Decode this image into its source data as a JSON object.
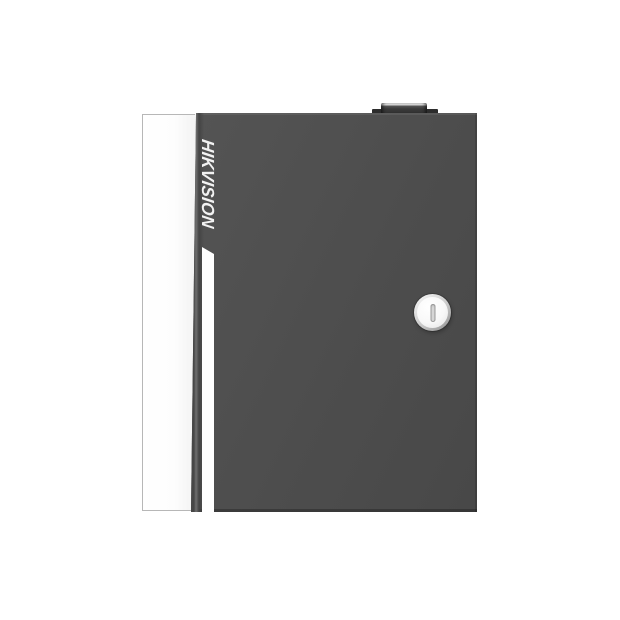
{
  "scene": {
    "background_color": "#ffffff"
  },
  "device": {
    "brand_label": "HIKVISION",
    "colors": {
      "door_face": "#4e4e4e",
      "door_edge_highlight": "#6f6f6f",
      "door_edge_shadow": "#454545",
      "door_bottom_edge": "#3a3a3a",
      "side_panel": "#ffffff",
      "side_panel_border": "#b7b7b7",
      "accent_stripe": "#ffffff",
      "top_knob": "#3a3a3a",
      "top_knob_highlight": "#d6d6d6",
      "top_plate": "#2c2c2c",
      "lock_ring_light": "#f2f2f2",
      "lock_ring_dark": "#8e8e8e",
      "lock_face": "#ffffff",
      "keyhole_slot": "#d8d8d8",
      "brand_text": "#f2f2f2"
    }
  }
}
